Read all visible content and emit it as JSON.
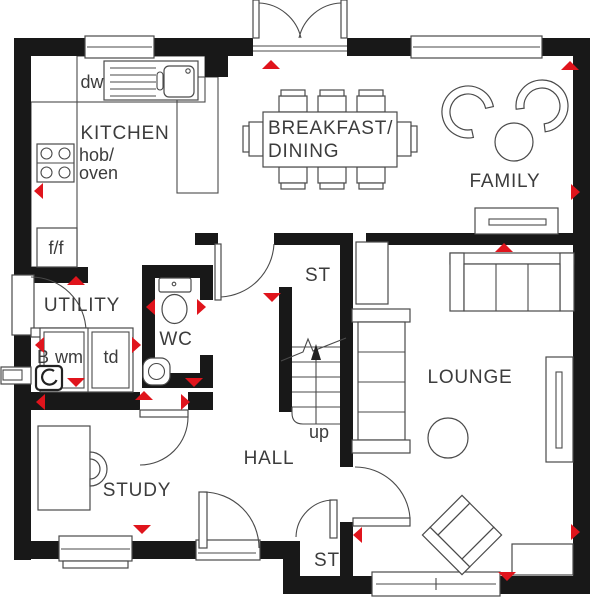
{
  "colors": {
    "wall": "#181818",
    "line": "#4a4a4a",
    "text": "#3c3c3c",
    "arrow": "#e0141c"
  },
  "rooms": {
    "kitchen": "KITCHEN",
    "breakfast_line1": "BREAKFAST/",
    "breakfast_line2": "DINING",
    "family": "FAMILY",
    "utility": "UTILITY",
    "wc": "WC",
    "storage_upper": "ST",
    "storage_lower": "ST",
    "hall": "HALL",
    "study": "STUDY",
    "lounge": "LOUNGE"
  },
  "labels": {
    "dishwasher": "dw",
    "hob_line1": "hob/",
    "hob_line2": "oven",
    "fridge_freezer": "f/f",
    "boiler": "B",
    "washing_machine": "wm",
    "tumble_dryer": "td",
    "stairs_up": "up"
  }
}
